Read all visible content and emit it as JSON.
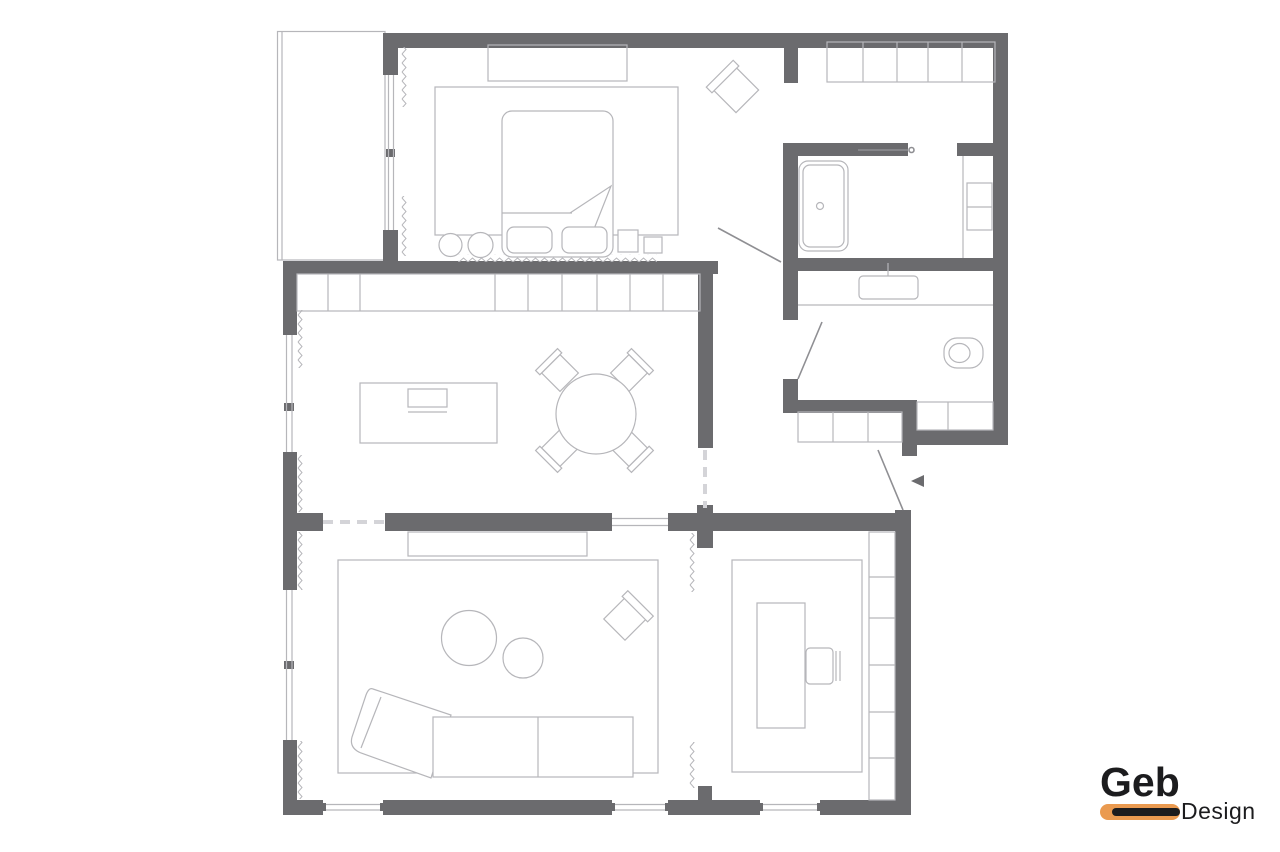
{
  "logo": {
    "brand": "Geb",
    "sub": "Design"
  },
  "colors": {
    "wall": "#6b6b6e",
    "line": "#b6b6ba",
    "door": "#8f8f93",
    "dash": "#d4d4d8",
    "accent": "#ea9a50",
    "ink": "#1c1c1e",
    "bg": "#ffffff"
  }
}
